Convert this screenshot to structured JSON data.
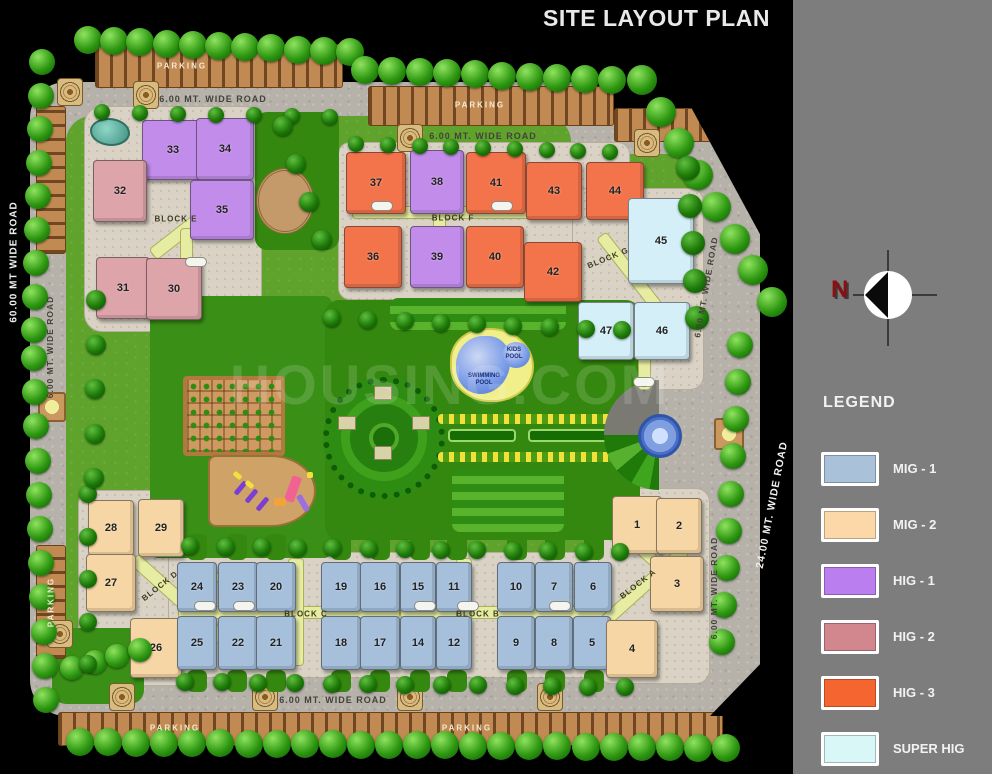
{
  "title": "SITE LAYOUT PLAN",
  "watermark": "HOUSING.COM",
  "compass": {
    "north": "N"
  },
  "legend": {
    "heading": "LEGEND",
    "items": [
      {
        "label": "MIG - 1",
        "type": "mig1",
        "color": "#a9c2da"
      },
      {
        "label": "MIG - 2",
        "type": "mig2",
        "color": "#fcd8a8"
      },
      {
        "label": "HIG - 1",
        "type": "hig1",
        "color": "#ba7eee"
      },
      {
        "label": "HIG - 2",
        "type": "hig2",
        "color": "#d2878f"
      },
      {
        "label": "HIG - 3",
        "type": "hig3",
        "color": "#f4652f"
      },
      {
        "label": "SUPER HIG",
        "type": "shig",
        "color": "#d8f7f6"
      }
    ]
  },
  "roads": [
    {
      "name": "road-label-top-left",
      "label": "6.00 MT. WIDE ROAD",
      "x": 213,
      "y": 99,
      "rot": 0,
      "tone": "dark",
      "size": 9
    },
    {
      "name": "road-label-top-mid",
      "label": "6.00 MT. WIDE ROAD",
      "x": 483,
      "y": 136,
      "rot": 0,
      "tone": "dark",
      "size": 9
    },
    {
      "name": "road-label-bottom",
      "label": "6.00 MT. WIDE ROAD",
      "x": 333,
      "y": 700,
      "rot": 0,
      "tone": "dark",
      "size": 9
    },
    {
      "name": "road-label-left",
      "label": "6.00 MT. WIDE ROAD",
      "x": 50,
      "y": 347,
      "rot": -90,
      "tone": "dark",
      "size": 8.5
    },
    {
      "name": "road-label-right-upper",
      "label": "6.00 MT. WIDE ROAD",
      "x": 706,
      "y": 287,
      "rot": -80,
      "tone": "dark",
      "size": 8.5
    },
    {
      "name": "road-label-right-lower",
      "label": "6.00 MT. WIDE ROAD",
      "x": 714,
      "y": 588,
      "rot": -90,
      "tone": "dark",
      "size": 8.5
    },
    {
      "name": "road-label-60m",
      "label": "60.00 MT WIDE ROAD",
      "x": 14,
      "y": 262,
      "rot": -90,
      "tone": "light",
      "size": 10
    },
    {
      "name": "road-label-24m",
      "label": "24.00 MT. WIDE ROAD",
      "x": 772,
      "y": 505,
      "rot": -79,
      "tone": "light",
      "size": 10.5
    }
  ],
  "parking_labels": [
    {
      "name": "parking-label-top-left",
      "label": "PARKING",
      "x": 182,
      "y": 66,
      "rot": 0
    },
    {
      "name": "parking-label-top-mid",
      "label": "PARKING",
      "x": 480,
      "y": 105,
      "rot": 0
    },
    {
      "name": "parking-label-bottom-1",
      "label": "PARKING",
      "x": 175,
      "y": 728,
      "rot": 0
    },
    {
      "name": "parking-label-bottom-2",
      "label": "PARKING",
      "x": 467,
      "y": 728,
      "rot": 0
    },
    {
      "name": "parking-label-left",
      "label": "PARKING",
      "x": 51,
      "y": 602,
      "rot": -90
    }
  ],
  "amenities": [
    {
      "name": "swimming-pool-label",
      "label": "SWIMMING POOL",
      "x": 484,
      "y": 380,
      "w": 38
    },
    {
      "name": "kids-pool-label",
      "label": "KIDS POOL",
      "x": 514,
      "y": 354,
      "w": 24
    }
  ],
  "blocks": [
    {
      "label": "BLOCK E",
      "lx": 176,
      "ly": 219,
      "rot": 0,
      "buildings": [
        {
          "no": "33",
          "type": "hig1",
          "x": 142,
          "y": 120,
          "w": 62,
          "h": 60
        },
        {
          "no": "34",
          "type": "hig1",
          "x": 196,
          "y": 118,
          "w": 58,
          "h": 62
        },
        {
          "no": "35",
          "type": "hig1",
          "x": 190,
          "y": 180,
          "w": 64,
          "h": 60
        },
        {
          "no": "32",
          "type": "hig2",
          "x": 93,
          "y": 160,
          "w": 54,
          "h": 62
        },
        {
          "no": "31",
          "type": "hig2",
          "x": 96,
          "y": 257,
          "w": 54,
          "h": 62
        },
        {
          "no": "30",
          "type": "hig2",
          "x": 146,
          "y": 258,
          "w": 56,
          "h": 62
        }
      ]
    },
    {
      "label": "BLOCK F",
      "lx": 453,
      "ly": 218,
      "rot": 0,
      "buildings": [
        {
          "no": "37",
          "type": "hig3",
          "x": 346,
          "y": 152,
          "w": 60,
          "h": 62
        },
        {
          "no": "38",
          "type": "hig1",
          "x": 410,
          "y": 150,
          "w": 54,
          "h": 64
        },
        {
          "no": "41",
          "type": "hig3",
          "x": 466,
          "y": 152,
          "w": 60,
          "h": 62
        },
        {
          "no": "43",
          "type": "hig3",
          "x": 526,
          "y": 162,
          "w": 56,
          "h": 58
        },
        {
          "no": "44",
          "type": "hig3",
          "x": 586,
          "y": 162,
          "w": 58,
          "h": 58
        },
        {
          "no": "36",
          "type": "hig3",
          "x": 344,
          "y": 226,
          "w": 58,
          "h": 62
        },
        {
          "no": "39",
          "type": "hig1",
          "x": 410,
          "y": 226,
          "w": 54,
          "h": 62
        },
        {
          "no": "40",
          "type": "hig3",
          "x": 466,
          "y": 226,
          "w": 58,
          "h": 62
        },
        {
          "no": "42",
          "type": "hig3",
          "x": 524,
          "y": 242,
          "w": 58,
          "h": 60
        }
      ]
    },
    {
      "label": "BLOCK G",
      "lx": 608,
      "ly": 258,
      "rot": -22,
      "buildings": [
        {
          "no": "45",
          "type": "shig",
          "x": 628,
          "y": 198,
          "w": 66,
          "h": 86
        },
        {
          "no": "47",
          "type": "shig",
          "x": 578,
          "y": 302,
          "w": 56,
          "h": 58
        },
        {
          "no": "46",
          "type": "shig",
          "x": 634,
          "y": 302,
          "w": 56,
          "h": 58
        }
      ]
    },
    {
      "label": "BLOCK D",
      "lx": 160,
      "ly": 586,
      "rot": -38,
      "buildings": [
        {
          "no": "28",
          "type": "mig2",
          "x": 88,
          "y": 500,
          "w": 46,
          "h": 56
        },
        {
          "no": "29",
          "type": "mig2",
          "x": 138,
          "y": 499,
          "w": 46,
          "h": 58
        },
        {
          "no": "27",
          "type": "mig2",
          "x": 86,
          "y": 554,
          "w": 50,
          "h": 58
        },
        {
          "no": "26",
          "type": "mig2",
          "x": 130,
          "y": 618,
          "w": 52,
          "h": 60
        }
      ]
    },
    {
      "label": "BLOCK C",
      "lx": 306,
      "ly": 614,
      "rot": 0,
      "buildings": [
        {
          "no": "24",
          "type": "mig1",
          "x": 177,
          "y": 562,
          "w": 40,
          "h": 50
        },
        {
          "no": "23",
          "type": "mig1",
          "x": 218,
          "y": 562,
          "w": 40,
          "h": 50
        },
        {
          "no": "20",
          "type": "mig1",
          "x": 256,
          "y": 562,
          "w": 40,
          "h": 50
        },
        {
          "no": "19",
          "type": "mig1",
          "x": 321,
          "y": 562,
          "w": 40,
          "h": 50
        },
        {
          "no": "16",
          "type": "mig1",
          "x": 360,
          "y": 562,
          "w": 40,
          "h": 50
        },
        {
          "no": "25",
          "type": "mig1",
          "x": 177,
          "y": 616,
          "w": 40,
          "h": 54
        },
        {
          "no": "22",
          "type": "mig1",
          "x": 218,
          "y": 616,
          "w": 40,
          "h": 54
        },
        {
          "no": "21",
          "type": "mig1",
          "x": 256,
          "y": 616,
          "w": 40,
          "h": 54
        },
        {
          "no": "18",
          "type": "mig1",
          "x": 321,
          "y": 616,
          "w": 40,
          "h": 54
        },
        {
          "no": "17",
          "type": "mig1",
          "x": 360,
          "y": 616,
          "w": 40,
          "h": 54
        }
      ]
    },
    {
      "label": "BLOCK B",
      "lx": 478,
      "ly": 614,
      "rot": 0,
      "buildings": [
        {
          "no": "15",
          "type": "mig1",
          "x": 400,
          "y": 562,
          "w": 36,
          "h": 50
        },
        {
          "no": "11",
          "type": "mig1",
          "x": 436,
          "y": 562,
          "w": 36,
          "h": 50
        },
        {
          "no": "10",
          "type": "mig1",
          "x": 497,
          "y": 562,
          "w": 38,
          "h": 50
        },
        {
          "no": "7",
          "type": "mig1",
          "x": 535,
          "y": 562,
          "w": 38,
          "h": 50
        },
        {
          "no": "6",
          "type": "mig1",
          "x": 574,
          "y": 562,
          "w": 38,
          "h": 50
        },
        {
          "no": "14",
          "type": "mig1",
          "x": 400,
          "y": 616,
          "w": 36,
          "h": 54
        },
        {
          "no": "12",
          "type": "mig1",
          "x": 436,
          "y": 616,
          "w": 36,
          "h": 54
        },
        {
          "no": "9",
          "type": "mig1",
          "x": 497,
          "y": 616,
          "w": 38,
          "h": 54
        },
        {
          "no": "8",
          "type": "mig1",
          "x": 535,
          "y": 616,
          "w": 38,
          "h": 54
        },
        {
          "no": "5",
          "type": "mig1",
          "x": 573,
          "y": 616,
          "w": 38,
          "h": 54
        }
      ]
    },
    {
      "label": "BLOCK A",
      "lx": 638,
      "ly": 584,
      "rot": -38,
      "buildings": [
        {
          "no": "1",
          "type": "mig2",
          "x": 612,
          "y": 496,
          "w": 50,
          "h": 58
        },
        {
          "no": "2",
          "type": "mig2",
          "x": 656,
          "y": 498,
          "w": 46,
          "h": 56
        },
        {
          "no": "3",
          "type": "mig2",
          "x": 650,
          "y": 556,
          "w": 54,
          "h": 56
        },
        {
          "no": "4",
          "type": "mig2",
          "x": 606,
          "y": 620,
          "w": 52,
          "h": 58
        }
      ]
    }
  ]
}
